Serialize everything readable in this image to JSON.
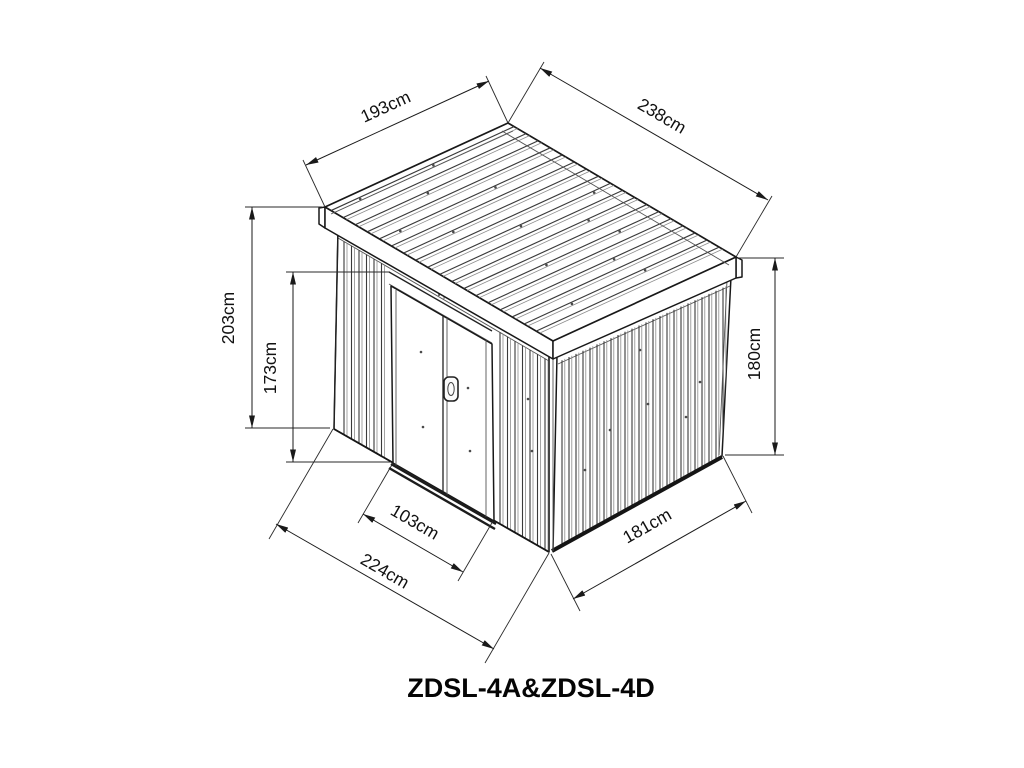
{
  "diagram_title": "ZDSL-4A&ZDSL-4D",
  "unit": "cm",
  "dimensions": {
    "roof_front_edge": "193cm",
    "roof_side_edge": "238cm",
    "front_height": "203cm",
    "door_height": "173cm",
    "rear_wall_height": "180cm",
    "door_width": "103cm",
    "base_front_width": "224cm",
    "base_side_depth": "181cm"
  },
  "colors": {
    "ink": "#1a1a1a",
    "paper": "#ffffff"
  }
}
